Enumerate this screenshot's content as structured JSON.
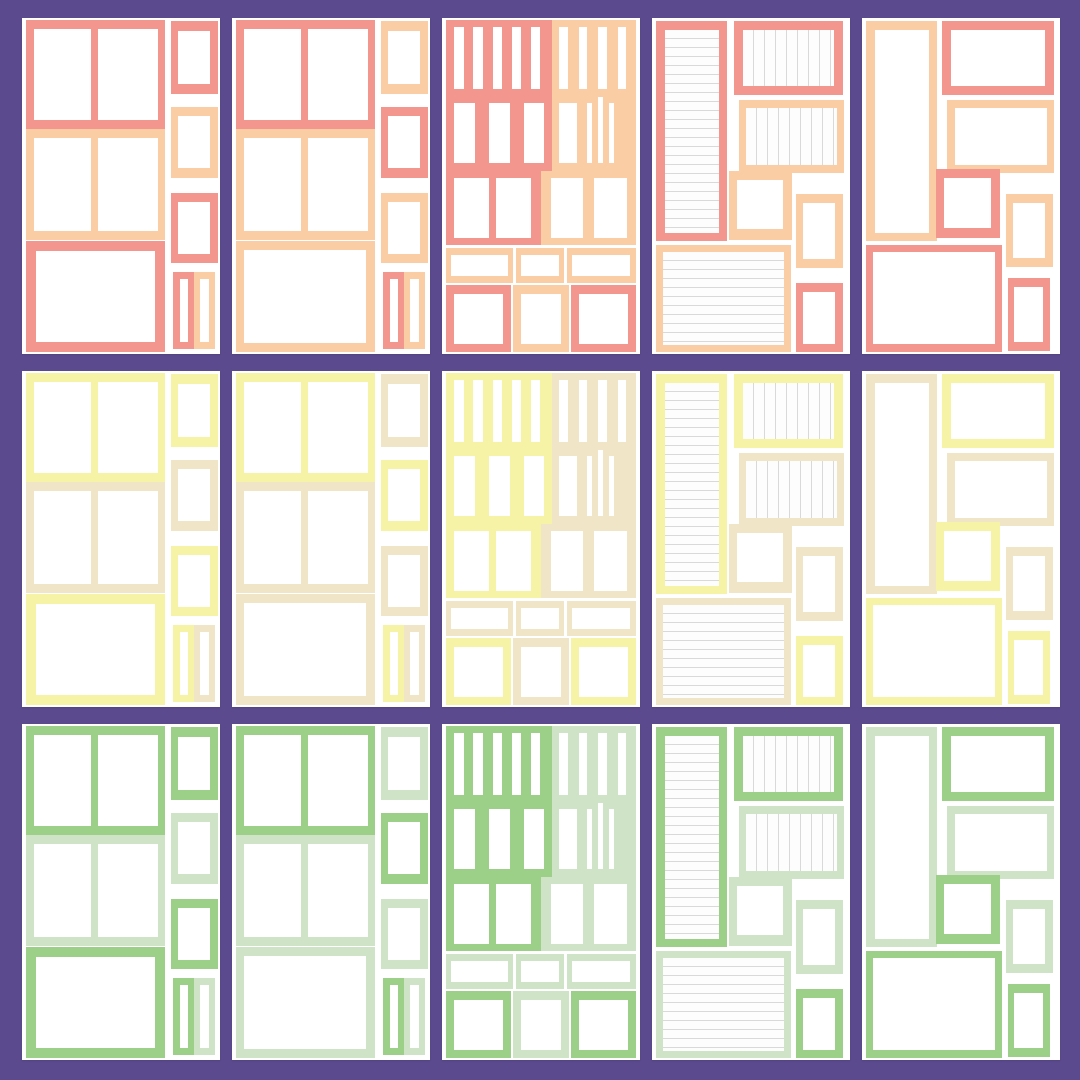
{
  "canvas": {
    "width": 1080,
    "height": 1080,
    "background_color": "#5b4a8e",
    "sheet_color": "#ffffff"
  },
  "lined_paper": {
    "paper_color": "#fdfdfd",
    "line_color": "#d9d9d9"
  },
  "palette_rows": [
    {
      "name": "coral",
      "primary": "#f2968e",
      "secondary": "#fbcda4"
    },
    {
      "name": "yellow",
      "primary": "#f6f2a6",
      "secondary": "#f0e5c6"
    },
    {
      "name": "green",
      "primary": "#9ccf87",
      "secondary": "#cfe3c7"
    }
  ],
  "column_layouts": [
    "photo-grid",
    "photo-grid-alt",
    "sticker-slots",
    "journal-lined",
    "mixed-frames"
  ],
  "layouts": {
    "photo-grid": {
      "boxes": [
        {
          "name": "photo-block-top",
          "x": 2,
          "y": 0.5,
          "w": 70,
          "h": 32.5,
          "color": "primary",
          "holes": [
            [
              6,
              9,
              41,
              83
            ],
            [
              52,
              9,
              43,
              83
            ]
          ]
        },
        {
          "name": "photo-block-middle",
          "x": 2,
          "y": 33,
          "w": 70,
          "h": 33,
          "color": "secondary",
          "holes": [
            [
              6,
              8,
              41,
              84
            ],
            [
              52,
              8,
              43,
              84
            ]
          ]
        },
        {
          "name": "photo-frame-large",
          "x": 2,
          "y": 66.5,
          "w": 70,
          "h": 33,
          "color": "primary",
          "holes": [
            [
              7,
              9,
              86,
              82
            ]
          ]
        },
        {
          "name": "side-frame-1",
          "x": 75,
          "y": 1,
          "w": 24,
          "h": 21.5,
          "color": "primary",
          "holes": [
            [
              16,
              13,
              68,
              74
            ]
          ]
        },
        {
          "name": "side-frame-2",
          "x": 75,
          "y": 26.5,
          "w": 24,
          "h": 21,
          "color": "secondary",
          "holes": [
            [
              16,
              13,
              68,
              74
            ]
          ]
        },
        {
          "name": "side-frame-3",
          "x": 75,
          "y": 52,
          "w": 24,
          "h": 21,
          "color": "primary",
          "holes": [
            [
              16,
              13,
              68,
              74
            ]
          ]
        },
        {
          "name": "side-strip-left",
          "x": 76.5,
          "y": 75.5,
          "w": 10.5,
          "h": 23,
          "color": "primary",
          "holes": [
            [
              30,
              9,
              40,
              82
            ]
          ]
        },
        {
          "name": "side-strip-right",
          "x": 87,
          "y": 75.5,
          "w": 10.5,
          "h": 23,
          "color": "secondary",
          "holes": [
            [
              30,
              9,
              40,
              82
            ]
          ]
        }
      ]
    },
    "photo-grid-alt": {
      "boxes": [
        {
          "name": "photo-block-top",
          "x": 2,
          "y": 0.5,
          "w": 70,
          "h": 32.5,
          "color": "primary",
          "holes": [
            [
              6,
              9,
              41,
              83
            ],
            [
              52,
              9,
              43,
              83
            ]
          ]
        },
        {
          "name": "photo-block-middle",
          "x": 2,
          "y": 33,
          "w": 70,
          "h": 33,
          "color": "secondary",
          "holes": [
            [
              6,
              8,
              41,
              84
            ],
            [
              52,
              8,
              43,
              84
            ]
          ]
        },
        {
          "name": "photo-frame-large",
          "x": 2,
          "y": 66.5,
          "w": 70,
          "h": 33,
          "color": "secondary",
          "holes": [
            [
              6,
              8,
              88,
              84
            ]
          ]
        },
        {
          "name": "side-frame-1",
          "x": 75,
          "y": 1,
          "w": 24,
          "h": 21.5,
          "color": "secondary",
          "holes": [
            [
              16,
              13,
              68,
              74
            ]
          ]
        },
        {
          "name": "side-frame-2",
          "x": 75,
          "y": 26.5,
          "w": 24,
          "h": 21,
          "color": "primary",
          "holes": [
            [
              16,
              13,
              68,
              74
            ]
          ]
        },
        {
          "name": "side-frame-3",
          "x": 75,
          "y": 52,
          "w": 24,
          "h": 21,
          "color": "secondary",
          "holes": [
            [
              16,
              13,
              68,
              74
            ]
          ]
        },
        {
          "name": "side-strip-left",
          "x": 76.5,
          "y": 75.5,
          "w": 10.5,
          "h": 23,
          "color": "primary",
          "holes": [
            [
              30,
              9,
              40,
              82
            ]
          ]
        },
        {
          "name": "side-strip-right",
          "x": 87,
          "y": 75.5,
          "w": 10.5,
          "h": 23,
          "color": "secondary",
          "holes": [
            [
              30,
              9,
              40,
              82
            ]
          ]
        }
      ]
    },
    "sticker-slots": {
      "boxes": [
        {
          "name": "tab-slots-block-left",
          "x": 2,
          "y": 0.5,
          "w": 53.5,
          "h": 22.5,
          "color": "primary",
          "holes": [
            [
              8,
              10,
              9,
              82
            ],
            [
              26,
              10,
              9,
              82
            ],
            [
              44,
              10,
              9,
              82
            ],
            [
              62,
              10,
              9,
              82
            ],
            [
              80,
              10,
              9,
              82
            ]
          ]
        },
        {
          "name": "tab-slots-block-right",
          "x": 55.5,
          "y": 0.5,
          "w": 42.5,
          "h": 22.5,
          "color": "secondary",
          "holes": [
            [
              9,
              10,
              10,
              82
            ],
            [
              32,
              10,
              10,
              82
            ],
            [
              55,
              10,
              10,
              82
            ],
            [
              78,
              10,
              10,
              82
            ]
          ]
        },
        {
          "name": "slot-block-left",
          "x": 2,
          "y": 23,
          "w": 53.5,
          "h": 22.5,
          "color": "primary",
          "holes": [
            [
              8,
              10,
              19,
              80
            ],
            [
              41,
              10,
              19,
              80
            ],
            [
              74,
              10,
              19,
              80
            ]
          ]
        },
        {
          "name": "slot-block-right",
          "x": 55.5,
          "y": 23,
          "w": 42.5,
          "h": 22.5,
          "color": "secondary",
          "holes": [
            [
              8,
              10,
              22,
              80
            ],
            [
              42,
              10,
              6,
              80
            ],
            [
              55,
              2,
              6,
              88
            ],
            [
              68,
              10,
              6,
              80
            ]
          ]
        },
        {
          "name": "box-block-left",
          "x": 2,
          "y": 45.5,
          "w": 48,
          "h": 22,
          "color": "primary",
          "holes": [
            [
              8,
              9,
              37,
              82
            ],
            [
              53,
              9,
              37,
              82
            ]
          ]
        },
        {
          "name": "box-block-right",
          "x": 50,
          "y": 45.5,
          "w": 48,
          "h": 22,
          "color": "secondary",
          "holes": [
            [
              10,
              9,
              34,
              82
            ],
            [
              56,
              9,
              34,
              82
            ]
          ]
        },
        {
          "name": "label-strip-1",
          "x": 2,
          "y": 68.5,
          "w": 34,
          "h": 10.5,
          "color": "secondary",
          "holes": [
            [
              8,
              20,
              84,
              60
            ]
          ]
        },
        {
          "name": "label-strip-2",
          "x": 37.5,
          "y": 68.5,
          "w": 24,
          "h": 10.5,
          "color": "secondary",
          "holes": [
            [
              10,
              20,
              80,
              60
            ]
          ]
        },
        {
          "name": "label-strip-3",
          "x": 63,
          "y": 68.5,
          "w": 35,
          "h": 10.5,
          "color": "secondary",
          "holes": [
            [
              8,
              20,
              84,
              60
            ]
          ]
        },
        {
          "name": "square-frame-1",
          "x": 2,
          "y": 79.5,
          "w": 33,
          "h": 20,
          "color": "primary",
          "holes": [
            [
              13,
              13,
              74,
              74
            ]
          ]
        },
        {
          "name": "square-frame-2",
          "x": 36,
          "y": 79.5,
          "w": 28,
          "h": 20,
          "color": "secondary",
          "holes": [
            [
              14,
              13,
              72,
              74
            ]
          ]
        },
        {
          "name": "square-frame-3",
          "x": 65,
          "y": 79.5,
          "w": 33,
          "h": 20,
          "color": "primary",
          "holes": [
            [
              13,
              13,
              74,
              74
            ]
          ]
        }
      ]
    },
    "journal-lined": {
      "boxes": [
        {
          "name": "journal-column-lined",
          "x": 2,
          "y": 1,
          "w": 36,
          "h": 65.5,
          "color": "primary",
          "holes": [
            [
              12,
              4,
              76,
              92,
              "h"
            ]
          ]
        },
        {
          "name": "ruled-panel-top",
          "x": 41.5,
          "y": 1,
          "w": 55,
          "h": 22,
          "color": "primary",
          "holes": [
            [
              8,
              12,
              84,
              76,
              "v"
            ]
          ]
        },
        {
          "name": "ruled-panel-middle",
          "x": 44,
          "y": 24.5,
          "w": 53,
          "h": 21.5,
          "color": "secondary",
          "holes": [
            [
              7,
              11,
              86,
              78,
              "v"
            ]
          ]
        },
        {
          "name": "square-frame",
          "x": 39,
          "y": 45.5,
          "w": 31.5,
          "h": 20.5,
          "color": "secondary",
          "holes": [
            [
              13,
              13,
              74,
              72
            ]
          ]
        },
        {
          "name": "small-frame-right",
          "x": 72.5,
          "y": 52.5,
          "w": 24,
          "h": 22,
          "color": "secondary",
          "holes": [
            [
              16,
              12,
              68,
              76
            ]
          ]
        },
        {
          "name": "note-panel-lined",
          "x": 2,
          "y": 67.5,
          "w": 68,
          "h": 32,
          "color": "secondary",
          "holes": [
            [
              5,
              7,
              90,
              86,
              "h"
            ]
          ]
        },
        {
          "name": "small-frame-bottom",
          "x": 72.5,
          "y": 79,
          "w": 24,
          "h": 20.5,
          "color": "primary",
          "holes": [
            [
              16,
              12,
              68,
              76
            ]
          ]
        }
      ]
    },
    "mixed-frames": {
      "boxes": [
        {
          "name": "tall-frame-left",
          "x": 2,
          "y": 1,
          "w": 36,
          "h": 65.5,
          "color": "secondary",
          "holes": [
            [
              12,
              4,
              76,
              92
            ]
          ]
        },
        {
          "name": "wide-frame-top",
          "x": 40.5,
          "y": 1,
          "w": 56.5,
          "h": 22,
          "color": "primary",
          "holes": [
            [
              8,
              12,
              84,
              76
            ]
          ]
        },
        {
          "name": "wide-frame-middle",
          "x": 43,
          "y": 24.5,
          "w": 54,
          "h": 21.5,
          "color": "secondary",
          "holes": [
            [
              7,
              11,
              86,
              78
            ]
          ]
        },
        {
          "name": "square-frame",
          "x": 37.5,
          "y": 45,
          "w": 32,
          "h": 20.5,
          "color": "primary",
          "holes": [
            [
              13,
              13,
              74,
              72
            ]
          ]
        },
        {
          "name": "small-frame-right",
          "x": 72.5,
          "y": 52.5,
          "w": 24,
          "h": 21.5,
          "color": "secondary",
          "holes": [
            [
              16,
              12,
              68,
              76
            ]
          ]
        },
        {
          "name": "large-frame-bottom",
          "x": 2,
          "y": 67.5,
          "w": 68.5,
          "h": 32,
          "color": "primary",
          "holes": [
            [
              5,
              7,
              90,
              85
            ]
          ]
        },
        {
          "name": "small-frame-bottom",
          "x": 73.5,
          "y": 77.5,
          "w": 21.5,
          "h": 21.5,
          "color": "primary",
          "holes": [
            [
              16,
              12,
              68,
              76
            ]
          ]
        }
      ]
    }
  }
}
